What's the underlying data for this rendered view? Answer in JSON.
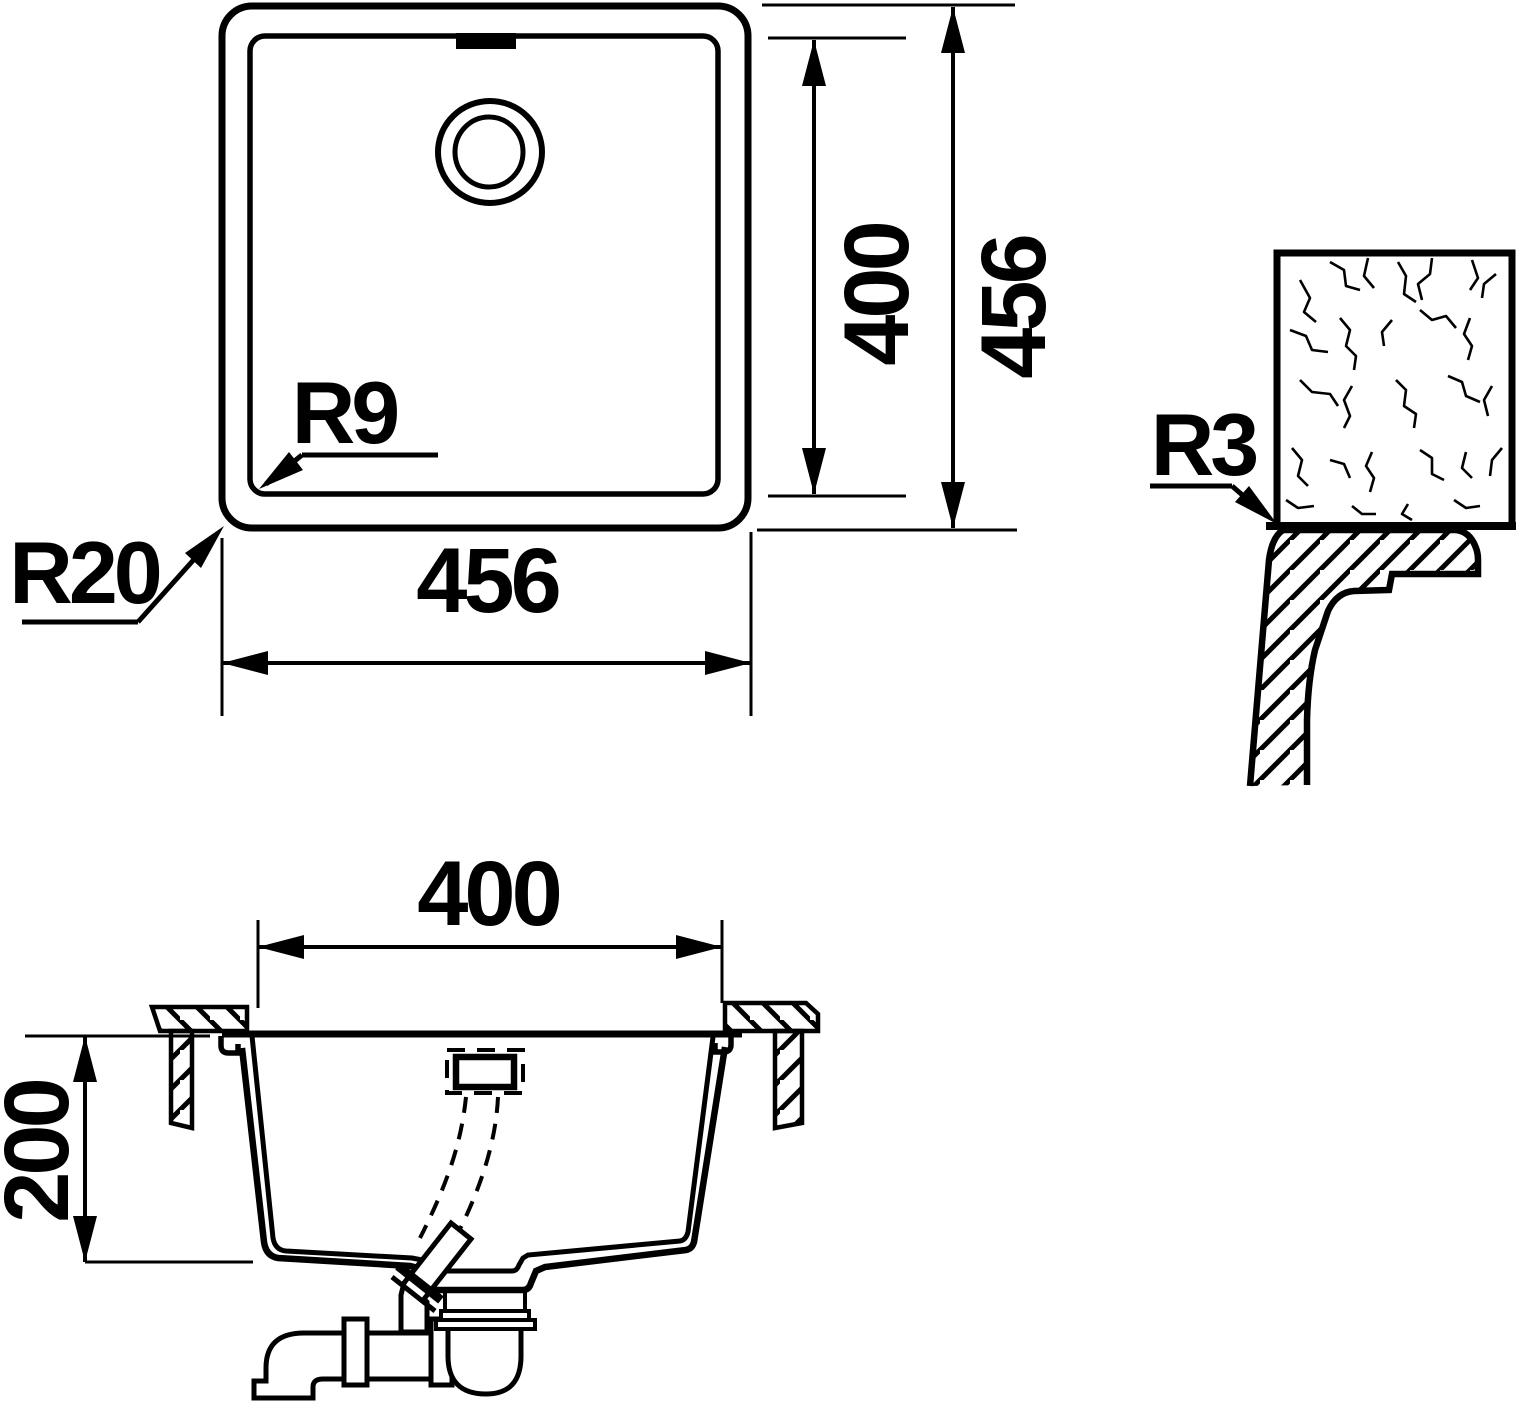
{
  "colors": {
    "ink": "#000000",
    "background": "#ffffff"
  },
  "labels": {
    "plan": {
      "width": "456",
      "inner_height": "400",
      "outer_height": "456",
      "inner_radius": "R9",
      "outer_radius": "R20"
    },
    "edge_detail": {
      "edge_radius": "R3"
    },
    "section": {
      "inner_width": "400",
      "depth": "200"
    }
  }
}
